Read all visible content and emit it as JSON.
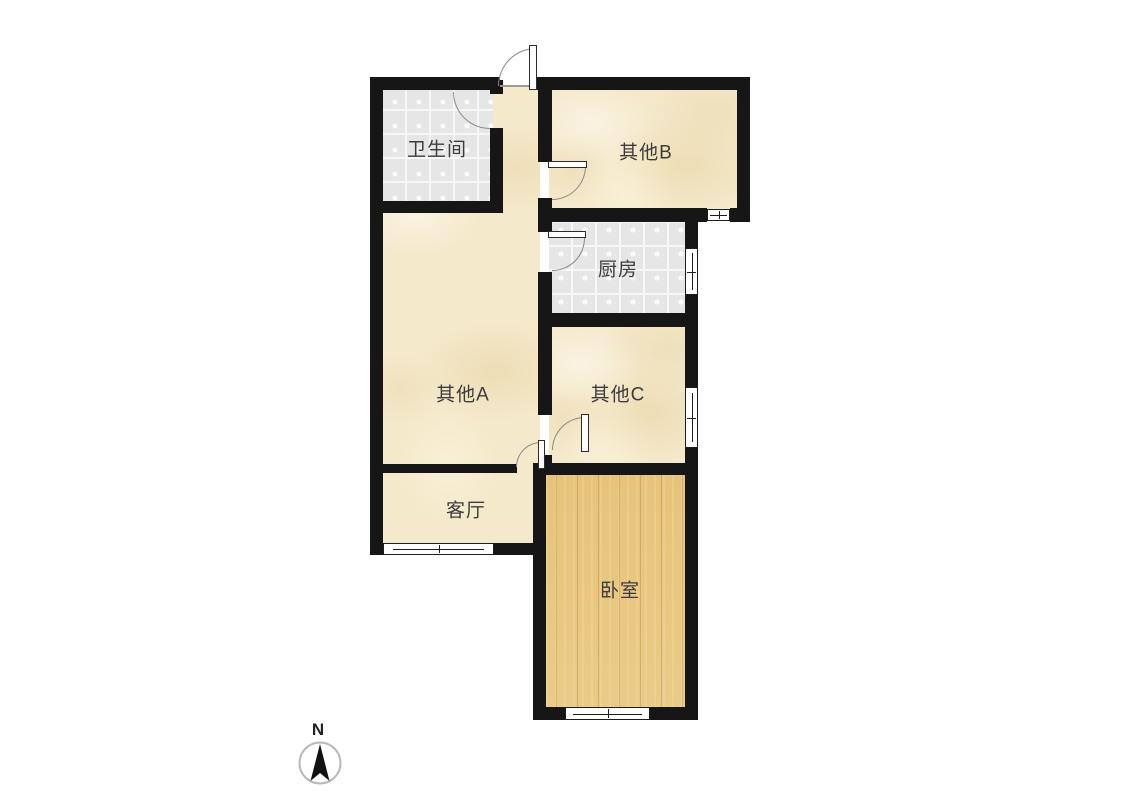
{
  "canvas": {
    "background": "#ffffff"
  },
  "rooms": {
    "bathroom": {
      "label": "卫生间",
      "floor": "tile"
    },
    "other_b": {
      "label": "其他B",
      "floor": "texture"
    },
    "kitchen": {
      "label": "厨房",
      "floor": "tile"
    },
    "other_a": {
      "label": "其他A",
      "floor": "texture"
    },
    "other_c": {
      "label": "其他C",
      "floor": "texture"
    },
    "living": {
      "label": "客厅",
      "floor": "texture"
    },
    "bedroom": {
      "label": "卧室",
      "floor": "wood"
    }
  },
  "compass": {
    "label": "N"
  },
  "colors": {
    "wall": "#161616",
    "room_beige": "#f5e9cb",
    "room_tile": "#e6e6e6",
    "room_wood": "#e9c77f",
    "door_arc": "#8a8a8a",
    "window_frame": "#1d1d1d",
    "background": "#ffffff"
  }
}
